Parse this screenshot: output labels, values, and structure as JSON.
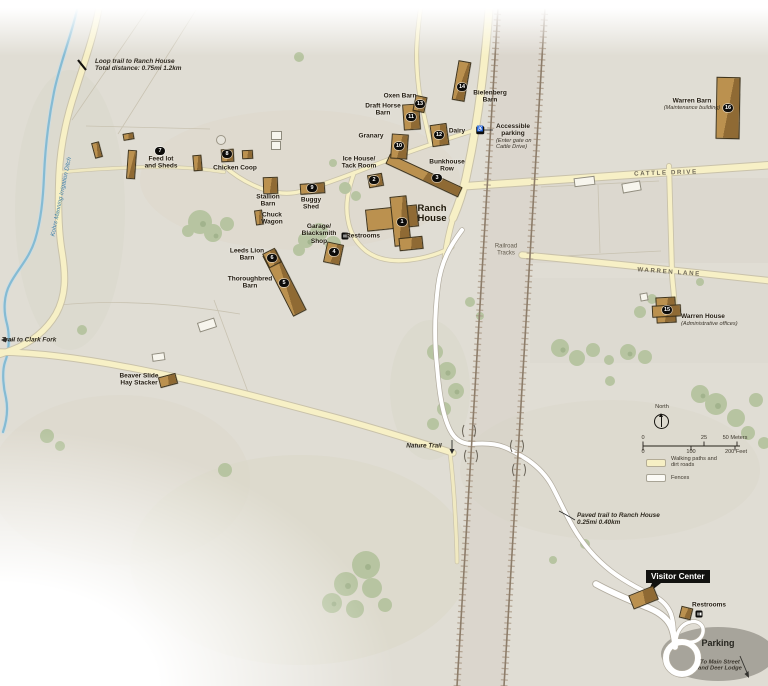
{
  "map": {
    "visitor_center": {
      "tag": "Visitor Center"
    },
    "buildings": [
      {
        "id": "ranch-house",
        "parts": [
          [
            392,
            218,
            52,
            22,
            -6
          ],
          [
            400,
            221,
            17,
            50,
            -6
          ],
          [
            411,
            243,
            24,
            13,
            -6
          ]
        ],
        "marker": "1",
        "mx": 402,
        "my": 222
      },
      {
        "id": "ice-house-tack-room",
        "parts": [
          [
            375,
            180,
            15,
            13,
            -10
          ]
        ],
        "marker": "2",
        "mx": 374,
        "my": 180
      },
      {
        "id": "bunkhouse-row",
        "parts": [
          [
            424,
            175,
            80,
            11,
            25
          ]
        ],
        "marker": "3",
        "mx": 437,
        "my": 178
      },
      {
        "id": "garage-blacksmith-shop",
        "parts": [
          [
            333,
            253,
            17,
            21,
            12
          ]
        ],
        "marker": "4",
        "mx": 334,
        "my": 252
      },
      {
        "id": "thoroughbred-barn",
        "parts": [
          [
            284,
            283,
            15,
            68,
            -27
          ]
        ],
        "marker": "5",
        "mx": 284,
        "my": 283
      },
      {
        "id": "leeds-lion-barn",
        "parts": [
          [
            272,
            258,
            14,
            16,
            -27
          ]
        ],
        "marker": "6",
        "mx": 272,
        "my": 258
      },
      {
        "id": "feed-lot-and-sheds",
        "parts": [
          [
            131,
            164,
            9,
            29,
            4
          ],
          [
            97,
            150,
            8,
            16,
            -15
          ],
          [
            128,
            136,
            11,
            7,
            -10
          ],
          [
            197,
            163,
            9,
            16,
            -5
          ]
        ],
        "marker": "7",
        "mx": 160,
        "my": 151
      },
      {
        "id": "chicken-coop",
        "parts": [
          [
            227,
            155,
            13,
            13,
            -3
          ],
          [
            247,
            154,
            11,
            9,
            -3
          ]
        ],
        "marker": "8",
        "mx": 227,
        "my": 154
      },
      {
        "id": "buggy-shed",
        "parts": [
          [
            312,
            188,
            25,
            11,
            -4
          ]
        ],
        "marker": "9",
        "mx": 312,
        "my": 188
      },
      {
        "id": "stallion-barn",
        "parts": [
          [
            270,
            185,
            15,
            17,
            -2
          ]
        ]
      },
      {
        "id": "chuck-wagon",
        "parts": [
          [
            259,
            217,
            8,
            15,
            -8
          ]
        ]
      },
      {
        "id": "granary",
        "parts": [
          [
            399,
            146,
            17,
            25,
            4
          ]
        ],
        "marker": "10",
        "mx": 399,
        "my": 146
      },
      {
        "id": "draft-horse-barn",
        "parts": [
          [
            411,
            117,
            17,
            26,
            -4
          ]
        ],
        "marker": "11",
        "mx": 411,
        "my": 117
      },
      {
        "id": "dairy",
        "parts": [
          [
            439,
            135,
            17,
            22,
            -8
          ]
        ],
        "marker": "12",
        "mx": 439,
        "my": 135
      },
      {
        "id": "oxen-barn",
        "parts": [
          [
            420,
            104,
            12,
            16,
            12
          ]
        ],
        "marker": "13",
        "mx": 420,
        "my": 104
      },
      {
        "id": "bielenberg-barn",
        "parts": [
          [
            461,
            81,
            13,
            40,
            10
          ]
        ],
        "marker": "14",
        "mx": 462,
        "my": 87
      },
      {
        "id": "warren-house",
        "parts": [
          [
            666,
            310,
            20,
            26,
            -3
          ],
          [
            666,
            311,
            29,
            12,
            -3
          ]
        ],
        "marker": "15",
        "mx": 667,
        "my": 310
      },
      {
        "id": "warren-barn",
        "parts": [
          [
            728,
            108,
            24,
            62,
            1
          ]
        ],
        "marker": "16",
        "mx": 728,
        "my": 108
      },
      {
        "id": "beaver-slide-hay-stacker",
        "parts": [
          [
            168,
            380,
            18,
            11,
            -15
          ]
        ]
      },
      {
        "id": "visitor-center",
        "parts": [
          [
            643,
            597,
            27,
            15,
            -22
          ]
        ]
      },
      {
        "id": "vc-restrooms",
        "parts": [
          [
            686,
            613,
            12,
            12,
            14
          ]
        ]
      },
      {
        "id": "shed-white-north",
        "type": "w",
        "parts": [
          [
            276,
            135,
            11,
            9,
            0
          ],
          [
            276,
            145,
            10,
            9,
            0
          ]
        ]
      },
      {
        "id": "shed-white-cattle",
        "type": "w",
        "parts": [
          [
            584,
            181,
            21,
            9,
            -7
          ],
          [
            631,
            187,
            19,
            10,
            -10
          ]
        ]
      },
      {
        "id": "shed-white-beaver",
        "type": "w",
        "parts": [
          [
            207,
            325,
            18,
            10,
            -18
          ],
          [
            158,
            357,
            13,
            8,
            -8
          ]
        ]
      },
      {
        "id": "shed-white-warren",
        "type": "w",
        "parts": [
          [
            644,
            297,
            8,
            8,
            -10
          ]
        ]
      }
    ],
    "labels": [
      {
        "id": "loop-trail",
        "t": "Loop trail to Ranch House\nTotal distance: 0.75mi  1.2km",
        "x": 95,
        "y": 58,
        "cls": "it",
        "a": "l"
      },
      {
        "id": "trail-to-clark-fork",
        "t": "Trail to Clark Fork",
        "x": 29,
        "y": 340,
        "cls": "it tc"
      },
      {
        "id": "stream-name",
        "t": "Kohrs Manning Irrigation Ditch",
        "x": 62,
        "y": 197,
        "cls": "st",
        "rot": -78
      },
      {
        "id": "feed-lot-and-sheds",
        "t": "Feed lot\nand Sheds",
        "x": 161,
        "y": 163,
        "cls": "b"
      },
      {
        "id": "chicken-coop",
        "t": "Chicken Coop",
        "x": 235,
        "y": 168,
        "cls": "b"
      },
      {
        "id": "stallion-barn",
        "t": "Stallion\nBarn",
        "x": 268,
        "y": 201,
        "cls": "b"
      },
      {
        "id": "buggy-shed",
        "t": "Buggy\nShed",
        "x": 311,
        "y": 204,
        "cls": "b"
      },
      {
        "id": "chuck-wagon",
        "t": "Chuck\nWagon",
        "x": 272,
        "y": 219,
        "cls": "b"
      },
      {
        "id": "garage-blacksmith-shop",
        "t": "Garage/\nBlacksmith\nShop",
        "x": 319,
        "y": 234,
        "cls": "b"
      },
      {
        "id": "ranch-restrooms",
        "t": "Restrooms",
        "x": 363,
        "y": 236,
        "cls": "b"
      },
      {
        "id": "leeds-lion-barn",
        "t": "Leeds Lion\nBarn",
        "x": 247,
        "y": 255,
        "cls": "b"
      },
      {
        "id": "thoroughbred-barn",
        "t": "Thoroughbred\nBarn",
        "x": 250,
        "y": 283,
        "cls": "b"
      },
      {
        "id": "oxen-barn",
        "t": "Oxen Barn",
        "x": 400,
        "y": 96,
        "cls": "b"
      },
      {
        "id": "draft-horse-barn",
        "t": "Draft Horse\nBarn",
        "x": 383,
        "y": 110,
        "cls": "b"
      },
      {
        "id": "granary",
        "t": "Granary",
        "x": 371,
        "y": 136,
        "cls": "b"
      },
      {
        "id": "dairy",
        "t": "Dairy",
        "x": 457,
        "y": 131,
        "cls": "b"
      },
      {
        "id": "bielenberg-barn",
        "t": "Bielenberg\nBarn",
        "x": 490,
        "y": 97,
        "cls": "b"
      },
      {
        "id": "ice-house-tack-room",
        "t": "Ice House/\nTack Room",
        "x": 359,
        "y": 163,
        "cls": "b"
      },
      {
        "id": "bunkhouse-row",
        "t": "Bunkhouse\nRow",
        "x": 447,
        "y": 166,
        "cls": "b"
      },
      {
        "id": "ranch-house",
        "t": "Ranch\nHouse",
        "x": 432,
        "y": 214,
        "cls": "bl"
      },
      {
        "id": "accessible-parking",
        "t": "Accessible\nparking",
        "x": 496,
        "y": 123,
        "cls": "b",
        "a": "l"
      },
      {
        "id": "accessible-parking-note",
        "t": "(Enter gate on\nCattle Drive)",
        "x": 496,
        "y": 138,
        "cls": "ti tii",
        "a": "l"
      },
      {
        "id": "cattle-drive",
        "t": "CATTLE DRIVE",
        "x": 666,
        "y": 174,
        "cls": "rd",
        "rot": -2
      },
      {
        "id": "warren-lane",
        "t": "WARREN LANE",
        "x": 669,
        "y": 273,
        "cls": "rd",
        "rot": 4
      },
      {
        "id": "railroad-tracks",
        "t": "Railroad\nTracks",
        "x": 506,
        "y": 250,
        "cls": "rr"
      },
      {
        "id": "warren-barn",
        "t": "Warren Barn",
        "x": 692,
        "y": 101,
        "cls": "b"
      },
      {
        "id": "warren-barn-note",
        "t": "(Maintenance building)",
        "x": 692,
        "y": 108,
        "cls": "ti tii tc"
      },
      {
        "id": "warren-house",
        "t": "Warren House",
        "x": 681,
        "y": 313,
        "cls": "b",
        "a": "l"
      },
      {
        "id": "warren-house-note",
        "t": "(Administrative offices)",
        "x": 681,
        "y": 321,
        "cls": "ti tii",
        "a": "l"
      },
      {
        "id": "beaver-slide-hay-stacker",
        "t": "Beaver Slide\nHay Stacker",
        "x": 139,
        "y": 380,
        "cls": "b"
      },
      {
        "id": "nature-trail",
        "t": "Nature Trail",
        "x": 424,
        "y": 446,
        "cls": "it tc"
      },
      {
        "id": "paved-trail",
        "t": "Paved trail to Ranch House\n0.25mi  0.40km",
        "x": 577,
        "y": 512,
        "cls": "it",
        "a": "l"
      },
      {
        "id": "vc-restrooms",
        "t": "Restrooms",
        "x": 709,
        "y": 605,
        "cls": "b"
      },
      {
        "id": "parking",
        "t": "Parking",
        "x": 718,
        "y": 643,
        "cls": "pk"
      },
      {
        "id": "to-main-street",
        "t": "To Main Street\nand Deer Lodge",
        "x": 720,
        "y": 666,
        "cls": "it2"
      },
      {
        "id": "north",
        "t": "North",
        "x": 662,
        "y": 407,
        "cls": "ti tc"
      },
      {
        "id": "scale-m-0",
        "t": "0",
        "x": 643,
        "y": 438,
        "cls": "ti tc"
      },
      {
        "id": "scale-m-25",
        "t": "25",
        "x": 704,
        "y": 438,
        "cls": "ti tc"
      },
      {
        "id": "scale-m-50",
        "t": "50 Meters",
        "x": 735,
        "y": 438,
        "cls": "ti tc"
      },
      {
        "id": "scale-f-0",
        "t": "0",
        "x": 643,
        "y": 452,
        "cls": "ti tc"
      },
      {
        "id": "scale-f-100",
        "t": "100",
        "x": 691,
        "y": 452,
        "cls": "ti tc"
      },
      {
        "id": "scale-f-200",
        "t": "200 Feet",
        "x": 736,
        "y": 452,
        "cls": "ti tc"
      },
      {
        "id": "legend-walking-paths",
        "t": "Walking paths and\ndirt roads",
        "x": 671,
        "y": 456,
        "cls": "ti",
        "a": "l"
      },
      {
        "id": "legend-fences",
        "t": "Fences",
        "x": 671,
        "y": 475,
        "cls": "ti",
        "a": "l"
      }
    ],
    "icons": [
      {
        "id": "ranch-restrooms",
        "kind": "rr",
        "x": 345,
        "y": 236
      },
      {
        "id": "vc-restrooms",
        "kind": "rr",
        "x": 699,
        "y": 614
      },
      {
        "id": "accessible-parking",
        "kind": "acc",
        "x": 480,
        "y": 130,
        "g": "♿"
      }
    ]
  }
}
